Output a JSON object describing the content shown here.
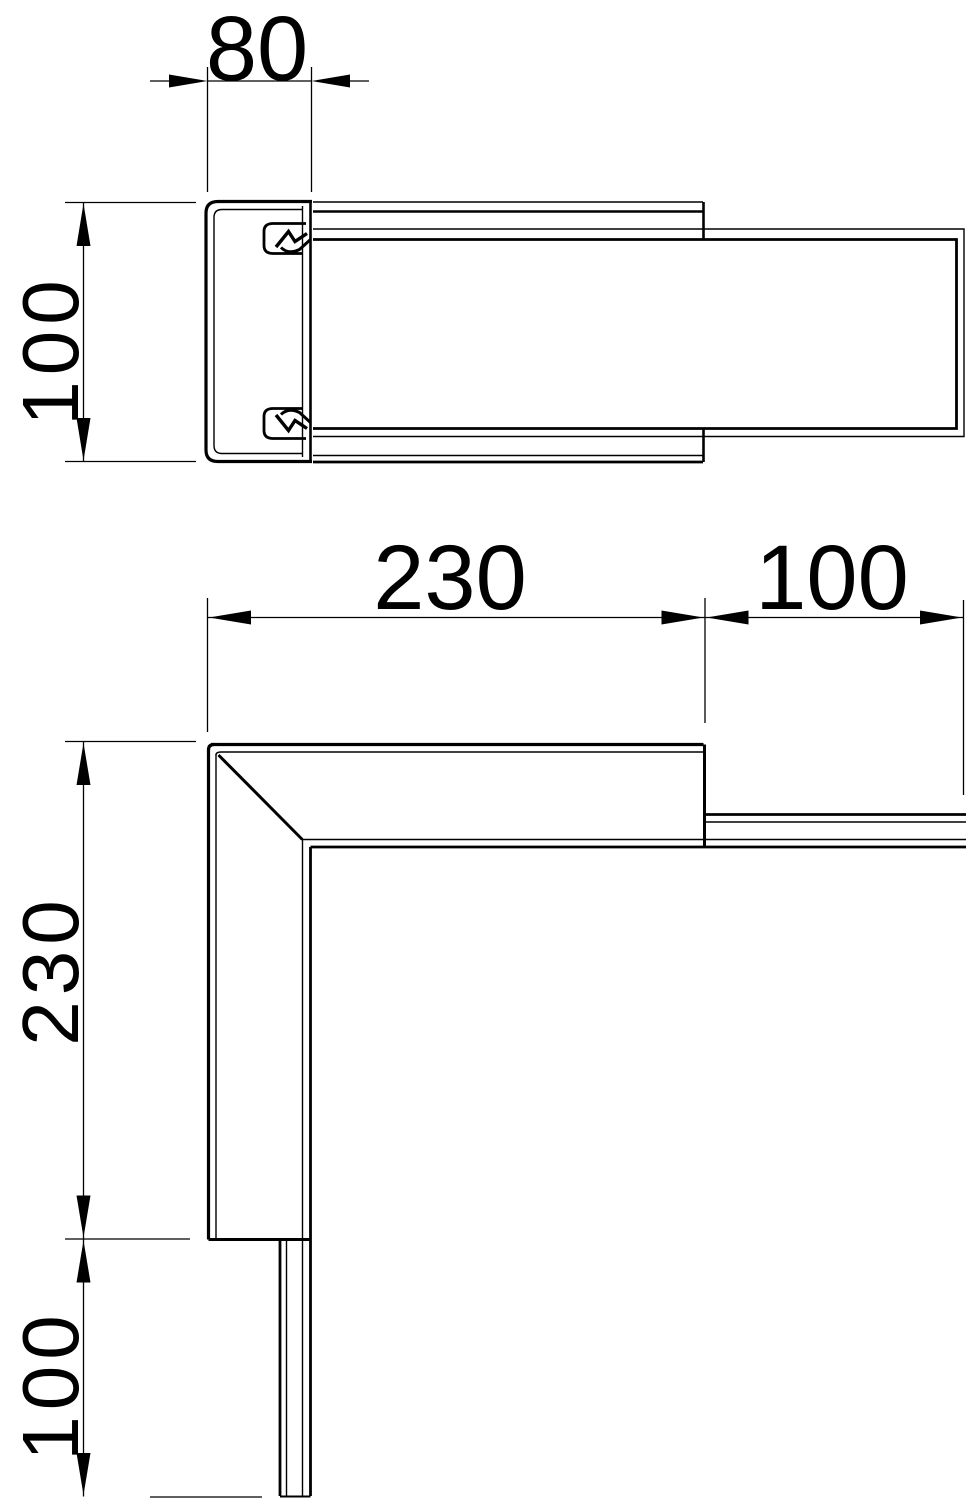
{
  "drawing": {
    "background_color": "#ffffff",
    "line_color": "#000000",
    "top_view": {
      "width_label": "80",
      "height_label": "100"
    },
    "front_view": {
      "horizontal_arm_label": "230",
      "horizontal_stub_label": "100",
      "vertical_arm_label": "230",
      "vertical_stub_label": "100"
    }
  }
}
